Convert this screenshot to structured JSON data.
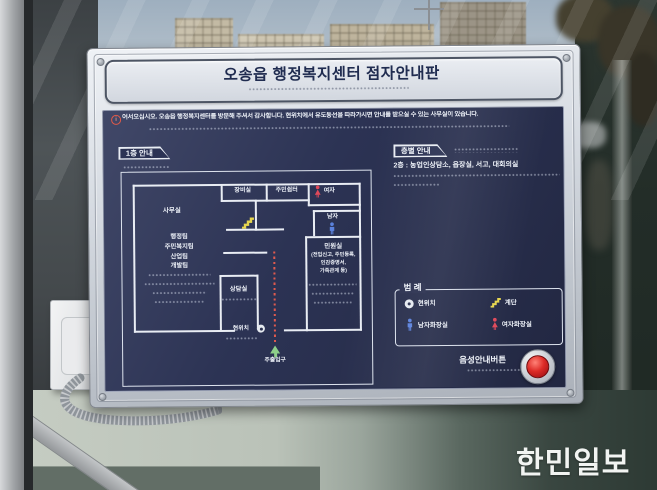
{
  "scene": {
    "watermark": "한민일보"
  },
  "sign": {
    "title": "오송읍 행정복지센터 점자안내판",
    "notice": "어서오십시오. 오송읍 행정복지센터를 방문해 주셔서 감사합니다. 현위치에서 유도동선을 따라가시면 안내를 받으실 수 있는 사무실이 있습니다.",
    "floor_map": {
      "tab": "1층 안내",
      "office": "사무실",
      "teams": [
        "행정팀",
        "주민복지팀",
        "산업팀",
        "개발팀"
      ],
      "equipment_room": "장비실",
      "rest_area": "주민쉼터",
      "women": "여자",
      "men": "남자",
      "civil_room": "민원실",
      "civil_detail": [
        "(전입신고, 주민등록,",
        "인감증명서,",
        "가족관계 등)"
      ],
      "counsel_room": "상담실",
      "current_location": "현위치",
      "main_entrance": "주출입구"
    },
    "floor_guide": {
      "tab": "층별 안내",
      "second_floor": "2층 : 농업인상담소, 읍장실, 서고, 대회의실"
    },
    "legend": {
      "title": "범 례",
      "current_location": "현위치",
      "stairs": "계단",
      "mens_restroom": "남자화장실",
      "womens_restroom": "여자화장실"
    },
    "voice_button": "음성안내버튼",
    "colors": {
      "board_navy": "#2b3152",
      "frame_silver": "#ccd1d8",
      "button_red": "#c3161f",
      "stairs_yellow": "#e6d54e",
      "men_blue": "#5b82dd",
      "women_red": "#e0495a",
      "guide_path_red": "#e05a4e",
      "entrance_green": "#8ecf8a"
    },
    "icons": {
      "notice": "info-circle-icon",
      "stairs": "stairs-zigzag-icon",
      "women": "female-figure-icon",
      "men": "male-figure-icon",
      "current_location": "location-dot-icon",
      "main_entrance": "up-arrow-icon",
      "voice": "red-push-button"
    }
  }
}
